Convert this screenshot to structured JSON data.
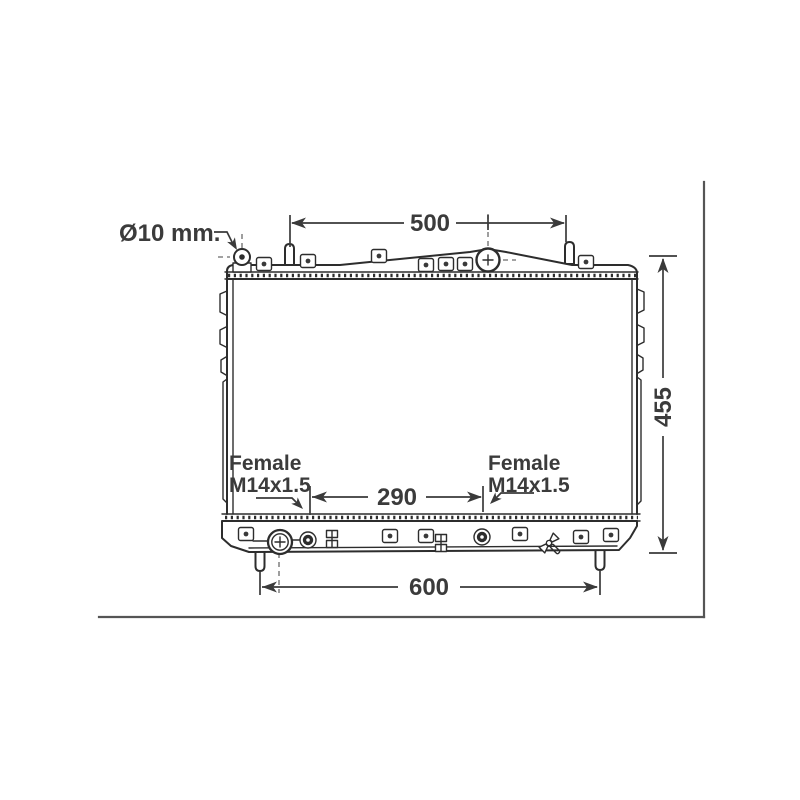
{
  "colors": {
    "background": "#ffffff",
    "line": "#2d2d2d",
    "dimension_text": "#3b3b3b",
    "frame_border": "#555555",
    "centerline": "#6a6a6a"
  },
  "labels": {
    "diameter_note": "Ø10 mm.",
    "port_left": {
      "line1": "Female",
      "line2": "M14x1.5"
    },
    "port_right": {
      "line1": "Female",
      "line2": "M14x1.5"
    }
  },
  "dimensions": {
    "top_width": "500",
    "overall_height": "455",
    "port_spacing": "290",
    "bottom_width": "600"
  },
  "icons": {
    "filler_cap": "filler-cap-icon",
    "drain_outlet": "drain-outlet-icon",
    "drain_valve": "drain-valve-icon",
    "mounting_clip": "mounting-clip-icon",
    "mounting_pin": "mounting-pin-icon",
    "oil_cooler_port": "oil-cooler-port-icon",
    "bracket_ladder": "ladder-bracket-icon",
    "top_pin_fitting": "round-pin-fitting-icon"
  }
}
